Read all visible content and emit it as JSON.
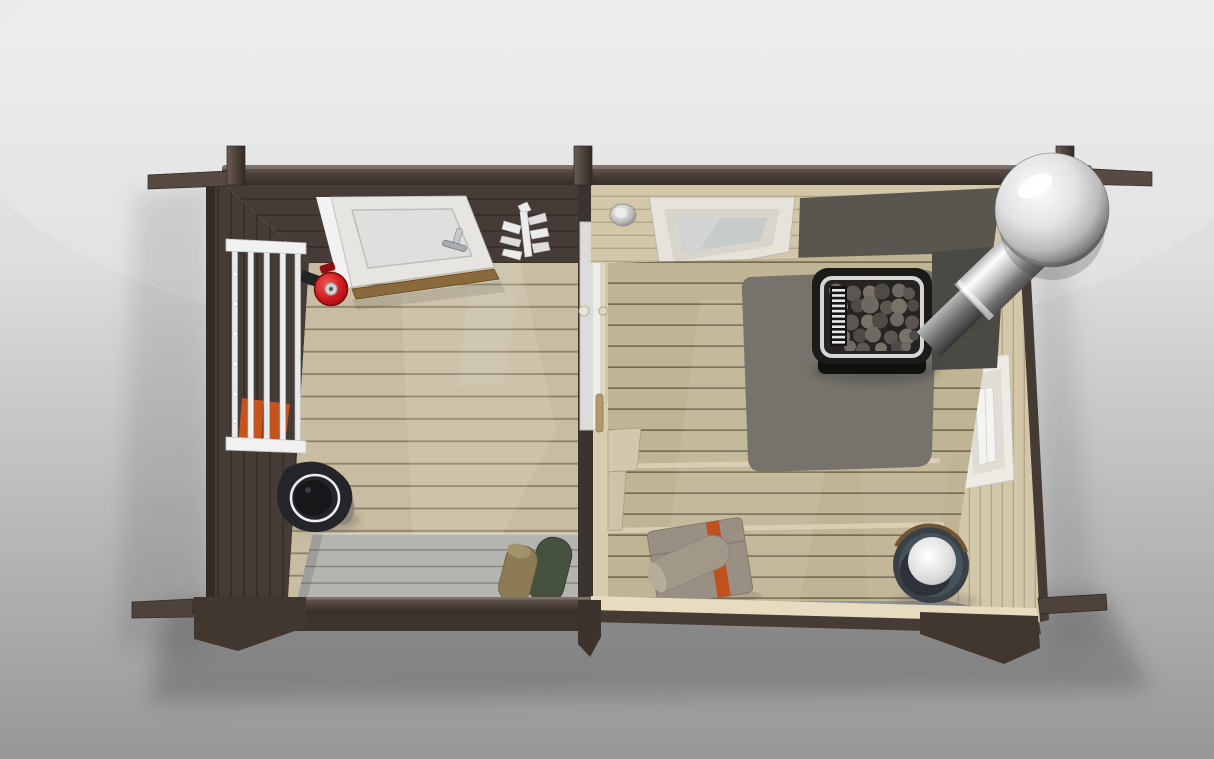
{
  "meta": {
    "kind": "3d-render",
    "description": "Top-down 3D visualization of a two-room log sauna cabin: dark-stained terrace/changing room on the left, light wood sauna room with heater and chimney on the right, on a neutral gray studio backdrop."
  },
  "scene": {
    "rooms": [
      {
        "name": "terrace-room",
        "description": "Dark brown changing/terrace room with beige plank floor, white entrance door, towel rack, fire extinguisher, gray bench and water bucket"
      },
      {
        "name": "sauna-room",
        "description": "Light spruce sauna room with tiered benches, wood-burning heater with stones, steel chimney with rain-cap ball, skylight, side window and wooden pail"
      }
    ],
    "objects": [
      {
        "name": "eave-beam",
        "description": "Dark brown top wall log with protruding corner joints"
      },
      {
        "name": "front-door",
        "description": "White entrance door shown ajar, opening inward, chrome handle"
      },
      {
        "name": "towel-rack",
        "description": "White wall-mounted drying rack with vertical bars and orange towel"
      },
      {
        "name": "fire-extinguisher",
        "description": "Red wall-mounted fire extinguisher seen from above"
      },
      {
        "name": "whisk-decoration",
        "description": "White branch-shaped sauna whisk ornament on the wall"
      },
      {
        "name": "water-bucket",
        "description": "Dark bucket with white rim standing on terrace floor"
      },
      {
        "name": "terrace-bench",
        "description": "Gray plank bench along the bottom wall with two rolled towels"
      },
      {
        "name": "partition-glass-door",
        "description": "Frosted glass door in the partition wall between rooms"
      },
      {
        "name": "ceiling-light",
        "description": "Round steel dome light in sauna ceiling edge"
      },
      {
        "name": "skylight",
        "description": "White framed roof window over the sauna"
      },
      {
        "name": "heat-shield",
        "description": "Dark gray protective panels behind and under the heater"
      },
      {
        "name": "sauna-heater",
        "description": "Black sauna stove filled with gray stones, white vent grille"
      },
      {
        "name": "chimney",
        "description": "Stainless steel flue pipe angled to the corner with spherical rain cap"
      },
      {
        "name": "side-window",
        "description": "Small white framed window in the right sauna wall"
      },
      {
        "name": "sauna-benches",
        "description": "Tiered light wood benches filling the sauna"
      },
      {
        "name": "folded-towels",
        "description": "Taupe towels with orange stripes on the lower bench"
      },
      {
        "name": "wooden-pail",
        "description": "Sauna pail with steel liner seen from above"
      }
    ]
  },
  "palette": {
    "bg_top": "#ebebeb",
    "bg_upper": "#dddddd",
    "bg_lower": "#b2b2b2",
    "bg_bottom": "#979797",
    "shadow": "#3a3a3a",
    "beam_hi": "#6b5d55",
    "beam": "#4e433c",
    "beam_dark": "#322a25",
    "wall_dark": "#463c37",
    "wall_dark_gap": "#39302c",
    "wall_outline": "#2e2722",
    "floor_plank": "#c8bda2",
    "floor_gap": "#8e8266",
    "deck_plank": "#bfb494",
    "deck_gap": "#776c52",
    "deck_hi": "#dcd3b8",
    "cream_wall": "#d3c7a9",
    "cream_gap": "#b3a687",
    "cream_edge": "#e8dcc0",
    "partition_cream": "#d8cdb1",
    "bench_gray": "#b4b4b1",
    "bench_gray_gap": "#82827f",
    "hearth": "#75736b",
    "shield": "#59564f",
    "shield_dark": "#4b4943",
    "stove_black": "#1d1b1a",
    "stove_rim": "#d6d6d4",
    "stove_inner": "#262422",
    "stone_a": "#6e6962",
    "stone_b": "#5b5651",
    "stone_c": "#787269",
    "stone_d": "#4e4a45",
    "steel_hi": "#fdfdfd",
    "steel_mid": "#b9b9b9",
    "steel_low": "#707070",
    "steel_dark": "#4f4f4f",
    "white": "#f2f2f2",
    "door_white": "#e6e5e2",
    "door_inner": "#d8dad8",
    "frame_gray": "#c2c2be",
    "glass": "#eef0ee",
    "glass_line": "#cfcfca",
    "sky_frame": "#e6e3da",
    "sky_mid": "#d7d5cc",
    "sky_glass": "#c7cbc9",
    "win_frame": "#edebe4",
    "win_glass": "#f4f5f3",
    "red": "#d21a1f",
    "red_hi": "#ef5a50",
    "red_dark": "#8e0f12",
    "metal_gray": "#cfcfcf",
    "orange": "#c4531d",
    "orange_hi": "#e0662a",
    "olive": "#8d7b55",
    "green_dark": "#47513f",
    "towel_taupe": "#998f82",
    "towel_stripe": "#c0511e",
    "towel_roll": "#a29889",
    "bucket_dark": "#23252a",
    "bucket_side": "#8f897b",
    "pail_outer": "#394046",
    "pail_slate": "#46525a",
    "pail_wood": "#6f5534",
    "wood_handle": "#b49a6d",
    "threshold": "#8a6a3a"
  }
}
